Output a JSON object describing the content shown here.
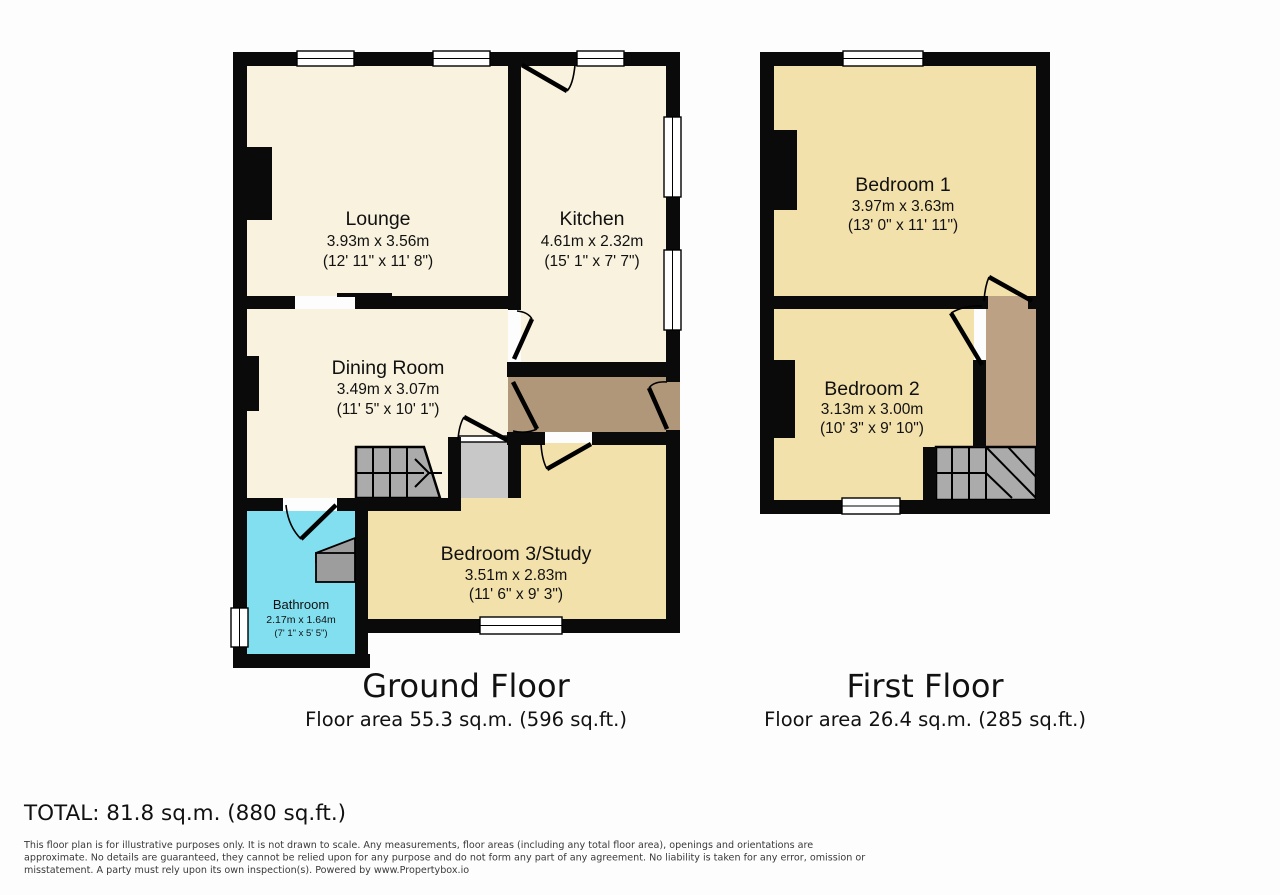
{
  "ground_floor": {
    "title": "Ground Floor",
    "area_label": "Floor area 55.3 sq.m. (596 sq.ft.)",
    "rooms": [
      {
        "name": "Lounge",
        "metric": "3.93m x 3.56m",
        "imperial": "(12' 11\" x 11' 8\")"
      },
      {
        "name": "Kitchen",
        "metric": "4.61m x 2.32m",
        "imperial": "(15' 1\" x 7' 7\")"
      },
      {
        "name": "Dining Room",
        "metric": "3.49m x 3.07m",
        "imperial": "(11' 5\" x 10' 1\")"
      },
      {
        "name": "Bedroom 3/Study",
        "metric": "3.51m x 2.83m",
        "imperial": "(11' 6\" x 9' 3\")"
      },
      {
        "name": "Bathroom",
        "metric": "2.17m x 1.64m",
        "imperial": "(7' 1\" x 5' 5\")"
      }
    ]
  },
  "first_floor": {
    "title": "First Floor",
    "area_label": "Floor area 26.4 sq.m. (285 sq.ft.)",
    "rooms": [
      {
        "name": "Bedroom 1",
        "metric": "3.97m x 3.63m",
        "imperial": "(13' 0\" x 11' 11\")"
      },
      {
        "name": "Bedroom 2",
        "metric": "3.13m x 3.00m",
        "imperial": "(10' 3\" x 9' 10\")"
      }
    ]
  },
  "total_label": "TOTAL: 81.8 sq.m. (880 sq.ft.)",
  "disclaimer_lines": [
    "This floor plan is for illustrative purposes only. It is not drawn to scale. Any measurements, floor areas (including any total floor area), openings and orientations are",
    "approximate. No details are guaranteed, they cannot be relied upon for any purpose and do not form any part of any agreement. No liability is taken for any error, omission or",
    "misstatement. A party must rely upon its own inspection(s). Powered by www.Propertybox.io"
  ],
  "colors": {
    "wall": "#0a0a0a",
    "cream_room": "#f8f2de",
    "gold_room": "#f3e1ab",
    "bathroom_cyan": "#82dff0",
    "hall_brown": "#b0977a",
    "landing_brown": "#bca184",
    "stair_gray": "#ababab",
    "vestibule_gray": "#c8c8c8",
    "fixture_gray": "#9d9d9d",
    "text_dark": "#111111",
    "disclaimer_gray": "#3a3a3a"
  }
}
